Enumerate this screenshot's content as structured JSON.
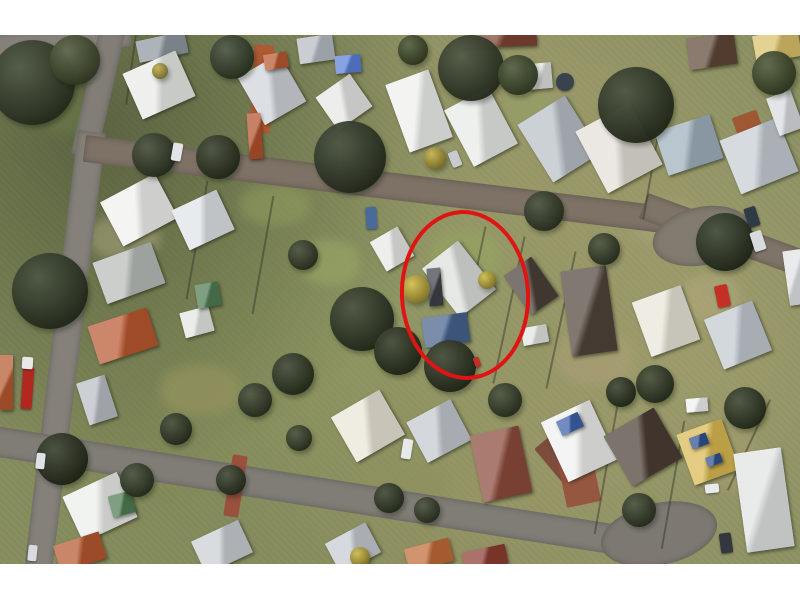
{
  "annotation": {
    "shape": "ellipse",
    "color": "#e11414",
    "stroke_width": 4,
    "x": 400,
    "y": 175,
    "w": 122,
    "h": 162,
    "rot": -3
  },
  "palette": {
    "page_margin": "#ffffff",
    "grass_base": "#8b9163",
    "road_gray": "#85817a",
    "road_brown_gray": "#7e7266",
    "highlight_red": "#e11414"
  },
  "photo_rect": {
    "x": 0,
    "y": 35,
    "w": 800,
    "h": 529
  },
  "scene": {
    "patches": [
      {
        "x": 90,
        "y": 180,
        "w": 70,
        "h": 45,
        "c": "#a3a07a"
      },
      {
        "x": 300,
        "y": 205,
        "w": 60,
        "h": 45,
        "c": "#9aa868"
      },
      {
        "x": 430,
        "y": 195,
        "w": 70,
        "h": 55,
        "c": "#96a562"
      },
      {
        "x": 630,
        "y": 165,
        "w": 70,
        "h": 45,
        "c": "#a8a478"
      },
      {
        "x": 555,
        "y": 295,
        "w": 80,
        "h": 55,
        "c": "#ab9f76"
      },
      {
        "x": 690,
        "y": 395,
        "w": 70,
        "h": 60,
        "c": "#a39c6e"
      },
      {
        "x": 160,
        "y": 330,
        "w": 80,
        "h": 50,
        "c": "#98955f"
      },
      {
        "x": 360,
        "y": 430,
        "w": 90,
        "h": 40,
        "c": "#8f9160"
      },
      {
        "x": 40,
        "y": 60,
        "w": 60,
        "h": 40,
        "c": "#6a7a4a"
      },
      {
        "x": 240,
        "y": 150,
        "w": 70,
        "h": 40,
        "c": "#8e9a5e"
      },
      {
        "x": 680,
        "y": 240,
        "w": 60,
        "h": 45,
        "c": "#b0a87c"
      },
      {
        "x": 500,
        "y": 55,
        "w": 60,
        "h": 40,
        "c": "#95a066"
      }
    ],
    "roads": [
      {
        "x": -10,
        "y": 0,
        "w": 140,
        "h": 26,
        "rot": -6,
        "og": "0 0",
        "c": "#85817a"
      },
      {
        "x": 100,
        "y": -8,
        "w": 26,
        "h": 130,
        "rot": 13,
        "og": "0 0",
        "c": "#827e77"
      },
      {
        "x": 78,
        "y": 95,
        "w": 28,
        "h": 450,
        "rot": 7,
        "og": "0 0",
        "c": "#85817a"
      },
      {
        "x": 86,
        "y": 100,
        "w": 590,
        "h": 27,
        "rot": 7,
        "og": "0 0",
        "c": "#7e7266"
      },
      {
        "x": 648,
        "y": 158,
        "w": 172,
        "h": 27,
        "rot": 20,
        "og": "0 0",
        "c": "#7e7467"
      },
      {
        "x": 652,
        "y": 172,
        "w": 100,
        "h": 58,
        "rot": -12,
        "rd": "50%",
        "c": "#817a6e"
      },
      {
        "x": -12,
        "y": 390,
        "w": 650,
        "h": 30,
        "rot": 9,
        "og": "0 0",
        "c": "#807c76"
      },
      {
        "x": 600,
        "y": 468,
        "w": 118,
        "h": 62,
        "rot": -12,
        "rd": "50%",
        "c": "#7d7972"
      }
    ],
    "driveways": [
      {
        "x": 252,
        "y": 10,
        "w": 20,
        "h": 88,
        "rot": 3,
        "c": "#b4552f"
      },
      {
        "x": 228,
        "y": 420,
        "w": 15,
        "h": 62,
        "rot": 9,
        "c": "#9b4a3a"
      },
      {
        "x": 543,
        "y": 392,
        "w": 52,
        "h": 46,
        "rot": -40,
        "c": "#7a4438"
      },
      {
        "x": 736,
        "y": 78,
        "w": 26,
        "h": 30,
        "rot": -20,
        "c": "#a0522d"
      },
      {
        "x": 560,
        "y": 405,
        "w": 35,
        "h": 65,
        "rot": -12,
        "c": "#96503c"
      }
    ],
    "fences": [
      {
        "x": 196,
        "y": 145,
        "w": 2,
        "h": 120,
        "rot": 10,
        "c": "#2f3327"
      },
      {
        "x": 262,
        "y": 160,
        "w": 2,
        "h": 120,
        "rot": 10,
        "c": "#2f3327"
      },
      {
        "x": 470,
        "y": 190,
        "w": 2,
        "h": 140,
        "rot": 12,
        "c": "#2f3327"
      },
      {
        "x": 508,
        "y": 200,
        "w": 2,
        "h": 150,
        "rot": 12,
        "c": "#2f3327"
      },
      {
        "x": 560,
        "y": 215,
        "w": 2,
        "h": 140,
        "rot": 12,
        "c": "#2f3327"
      },
      {
        "x": 650,
        "y": 95,
        "w": 2,
        "h": 90,
        "rot": 10,
        "c": "#2f3327"
      },
      {
        "x": 605,
        "y": 370,
        "w": 2,
        "h": 130,
        "rot": 10,
        "c": "#2f3327"
      },
      {
        "x": 672,
        "y": 385,
        "w": 2,
        "h": 130,
        "rot": 10,
        "c": "#2f3327"
      },
      {
        "x": 130,
        "y": 0,
        "w": 2,
        "h": 70,
        "rot": 8,
        "c": "#2f3327"
      },
      {
        "x": 748,
        "y": 360,
        "w": 2,
        "h": 100,
        "rot": 25,
        "c": "#2f3327"
      }
    ],
    "houses": [
      {
        "x": 137,
        "y": 1,
        "w": 50,
        "h": 22,
        "rot": -12,
        "c": "#8f969e"
      },
      {
        "x": 130,
        "y": 25,
        "w": 58,
        "h": 50,
        "rot": -24,
        "c": "#e9ebe7"
      },
      {
        "x": 298,
        "y": 1,
        "w": 36,
        "h": 26,
        "rot": -8,
        "c": "#b6bbc2"
      },
      {
        "x": 248,
        "y": 27,
        "w": 48,
        "h": 55,
        "rot": -30,
        "c": "#cfd3d8"
      },
      {
        "x": 264,
        "y": 18,
        "w": 24,
        "h": 16,
        "rot": -10,
        "c": "#b5572f"
      },
      {
        "x": 248,
        "y": 78,
        "w": 14,
        "h": 46,
        "rot": -4,
        "c": "#b0502c"
      },
      {
        "x": 335,
        "y": 20,
        "w": 26,
        "h": 18,
        "rot": -5,
        "c": "#5a7fd6"
      },
      {
        "x": 323,
        "y": 47,
        "w": 42,
        "h": 40,
        "rot": -35,
        "c": "#e6e7e4"
      },
      {
        "x": 396,
        "y": 40,
        "w": 46,
        "h": 72,
        "rot": -20,
        "c": "#eef0ec"
      },
      {
        "x": 456,
        "y": 60,
        "w": 50,
        "h": 64,
        "rot": -28,
        "c": "#e8eae6"
      },
      {
        "x": 462,
        "y": 0,
        "w": 75,
        "h": 12,
        "rot": -2,
        "c": "#7e4434"
      },
      {
        "x": 528,
        "y": 28,
        "w": 24,
        "h": 26,
        "rot": -5,
        "c": "#dfe1de"
      },
      {
        "x": 531,
        "y": 70,
        "w": 56,
        "h": 68,
        "rot": -32,
        "c": "#b9bfc6"
      },
      {
        "x": 588,
        "y": 78,
        "w": 62,
        "h": 70,
        "rot": -28,
        "c": "#e3e0d8"
      },
      {
        "x": 660,
        "y": 87,
        "w": 58,
        "h": 46,
        "rot": -18,
        "c": "#9fb0bd"
      },
      {
        "x": 728,
        "y": 92,
        "w": 62,
        "h": 58,
        "rot": -22,
        "c": "#c6cdd4"
      },
      {
        "x": 688,
        "y": 0,
        "w": 48,
        "h": 32,
        "rot": -8,
        "c": "#5e4637"
      },
      {
        "x": 754,
        "y": -3,
        "w": 46,
        "h": 28,
        "rot": -10,
        "c": "#d9c06a"
      },
      {
        "x": 772,
        "y": 58,
        "w": 26,
        "h": 40,
        "rot": -20,
        "c": "#d8dbde"
      },
      {
        "x": 108,
        "y": 150,
        "w": 62,
        "h": 50,
        "rot": -28,
        "c": "#f0f1ee"
      },
      {
        "x": 178,
        "y": 163,
        "w": 50,
        "h": 44,
        "rot": -25,
        "c": "#dfe3e6"
      },
      {
        "x": 98,
        "y": 216,
        "w": 62,
        "h": 44,
        "rot": -20,
        "c": "#b7bcb9"
      },
      {
        "x": 92,
        "y": 281,
        "w": 62,
        "h": 40,
        "rot": -18,
        "c": "#b9572f"
      },
      {
        "x": 182,
        "y": 274,
        "w": 30,
        "h": 26,
        "rot": -15,
        "c": "#e4e6e3"
      },
      {
        "x": 196,
        "y": 248,
        "w": 24,
        "h": 24,
        "rot": -10,
        "c": "#4e7a52"
      },
      {
        "x": 376,
        "y": 197,
        "w": 32,
        "h": 34,
        "rot": -30,
        "c": "#e7e9e6"
      },
      {
        "x": 436,
        "y": 213,
        "w": 46,
        "h": 62,
        "rot": -38,
        "c": "#dcdfdc"
      },
      {
        "x": 428,
        "y": 233,
        "w": 14,
        "h": 38,
        "rot": -5,
        "c": "#3c4148"
      },
      {
        "x": 423,
        "y": 280,
        "w": 46,
        "h": 30,
        "rot": -8,
        "c": "#46628c"
      },
      {
        "x": 514,
        "y": 227,
        "w": 34,
        "h": 48,
        "rot": -35,
        "c": "#4a4038"
      },
      {
        "x": 522,
        "y": 291,
        "w": 26,
        "h": 18,
        "rot": -10,
        "c": "#e2e4e1"
      },
      {
        "x": 566,
        "y": 233,
        "w": 46,
        "h": 86,
        "rot": -8,
        "c": "#4f443a"
      },
      {
        "x": 640,
        "y": 257,
        "w": 52,
        "h": 58,
        "rot": -20,
        "c": "#e8e4d8"
      },
      {
        "x": 712,
        "y": 273,
        "w": 52,
        "h": 54,
        "rot": -22,
        "c": "#c2c9d0"
      },
      {
        "x": 786,
        "y": 215,
        "w": 18,
        "h": 55,
        "rot": -8,
        "c": "#dfe2e5"
      },
      {
        "x": 340,
        "y": 365,
        "w": 56,
        "h": 52,
        "rot": -30,
        "c": "#e9e4d6"
      },
      {
        "x": 414,
        "y": 373,
        "w": 50,
        "h": 46,
        "rot": -28,
        "c": "#c3c8cf"
      },
      {
        "x": 476,
        "y": 395,
        "w": 50,
        "h": 68,
        "rot": -12,
        "c": "#8a4a3a"
      },
      {
        "x": 552,
        "y": 373,
        "w": 54,
        "h": 66,
        "rot": -25,
        "c": "#eff0ee"
      },
      {
        "x": 558,
        "y": 381,
        "w": 24,
        "h": 16,
        "rot": -25,
        "c": "#3b5fa8"
      },
      {
        "x": 614,
        "y": 383,
        "w": 58,
        "h": 58,
        "rot": -30,
        "c": "#4a3d33"
      },
      {
        "x": 684,
        "y": 390,
        "w": 48,
        "h": 54,
        "rot": -20,
        "c": "#d9b952"
      },
      {
        "x": 690,
        "y": 400,
        "w": 18,
        "h": 12,
        "rot": -20,
        "c": "#2f4f8f"
      },
      {
        "x": 706,
        "y": 420,
        "w": 16,
        "h": 10,
        "rot": -20,
        "c": "#2f4f8f"
      },
      {
        "x": 740,
        "y": 415,
        "w": 48,
        "h": 100,
        "rot": -8,
        "c": "#dfe3e2"
      },
      {
        "x": 686,
        "y": 363,
        "w": 22,
        "h": 14,
        "rot": -5,
        "c": "#eef0ef"
      },
      {
        "x": 70,
        "y": 447,
        "w": 60,
        "h": 50,
        "rot": -25,
        "c": "#eceeeb"
      },
      {
        "x": 110,
        "y": 458,
        "w": 24,
        "h": 22,
        "rot": -15,
        "c": "#4e7a52"
      },
      {
        "x": 56,
        "y": 503,
        "w": 48,
        "h": 28,
        "rot": -18,
        "c": "#b5572f"
      },
      {
        "x": 196,
        "y": 494,
        "w": 52,
        "h": 36,
        "rot": -25,
        "c": "#c9ced3"
      },
      {
        "x": 330,
        "y": 496,
        "w": 46,
        "h": 34,
        "rot": -28,
        "c": "#c6cbd1"
      },
      {
        "x": 406,
        "y": 508,
        "w": 46,
        "h": 24,
        "rot": -15,
        "c": "#c06a38"
      },
      {
        "x": 463,
        "y": 513,
        "w": 44,
        "h": 20,
        "rot": -12,
        "c": "#8a3c30"
      },
      {
        "x": 0,
        "y": 320,
        "w": 13,
        "h": 55,
        "rot": 0,
        "c": "#b5572f"
      },
      {
        "x": 82,
        "y": 343,
        "w": 30,
        "h": 44,
        "rot": -18,
        "c": "#b9bec4"
      }
    ],
    "trees": [
      {
        "x": -10,
        "y": 5,
        "d": 85,
        "c": "#39442c"
      },
      {
        "x": 50,
        "y": 0,
        "d": 50,
        "c": "#4a5634"
      },
      {
        "x": 12,
        "y": 218,
        "d": 76,
        "c": "#343f28"
      },
      {
        "x": 132,
        "y": 98,
        "d": 44,
        "c": "#39442c"
      },
      {
        "x": 196,
        "y": 100,
        "d": 44,
        "c": "#323c26"
      },
      {
        "x": 210,
        "y": 0,
        "d": 44,
        "c": "#3c4830"
      },
      {
        "x": 314,
        "y": 86,
        "d": 72,
        "c": "#343e29"
      },
      {
        "x": 438,
        "y": 0,
        "d": 66,
        "c": "#39432c"
      },
      {
        "x": 598,
        "y": 32,
        "d": 76,
        "c": "#333d27"
      },
      {
        "x": 398,
        "y": 0,
        "d": 30,
        "c": "#45522f"
      },
      {
        "x": 498,
        "y": 20,
        "d": 40,
        "c": "#42502e"
      },
      {
        "x": 752,
        "y": 16,
        "d": 44,
        "c": "#45522f"
      },
      {
        "x": 524,
        "y": 156,
        "d": 40,
        "c": "#39432c"
      },
      {
        "x": 588,
        "y": 198,
        "d": 32,
        "c": "#3a442c"
      },
      {
        "x": 696,
        "y": 178,
        "d": 58,
        "c": "#2f3a25"
      },
      {
        "x": 330,
        "y": 252,
        "d": 64,
        "c": "#333d27"
      },
      {
        "x": 374,
        "y": 292,
        "d": 48,
        "c": "#2e3722"
      },
      {
        "x": 424,
        "y": 305,
        "d": 52,
        "c": "#2f3823"
      },
      {
        "x": 288,
        "y": 205,
        "d": 30,
        "c": "#39432c"
      },
      {
        "x": 636,
        "y": 330,
        "d": 38,
        "c": "#353f28"
      },
      {
        "x": 606,
        "y": 342,
        "d": 30,
        "c": "#2f3823"
      },
      {
        "x": 488,
        "y": 348,
        "d": 34,
        "c": "#39432c"
      },
      {
        "x": 272,
        "y": 318,
        "d": 42,
        "c": "#333d27"
      },
      {
        "x": 238,
        "y": 348,
        "d": 34,
        "c": "#39432c"
      },
      {
        "x": 160,
        "y": 378,
        "d": 32,
        "c": "#343e28"
      },
      {
        "x": 36,
        "y": 398,
        "d": 52,
        "c": "#2c3520"
      },
      {
        "x": 120,
        "y": 428,
        "d": 34,
        "c": "#39432c"
      },
      {
        "x": 216,
        "y": 430,
        "d": 30,
        "c": "#343e28"
      },
      {
        "x": 286,
        "y": 390,
        "d": 26,
        "c": "#3a442c"
      },
      {
        "x": 724,
        "y": 352,
        "d": 42,
        "c": "#333d27"
      },
      {
        "x": 622,
        "y": 458,
        "d": 34,
        "c": "#39432c"
      },
      {
        "x": 374,
        "y": 448,
        "d": 30,
        "c": "#343e28"
      },
      {
        "x": 414,
        "y": 462,
        "d": 26,
        "c": "#39432c"
      },
      {
        "x": 402,
        "y": 240,
        "d": 28,
        "c": "#d2bb3e"
      },
      {
        "x": 478,
        "y": 236,
        "d": 18,
        "c": "#cdb73c"
      },
      {
        "x": 424,
        "y": 112,
        "d": 22,
        "c": "#c0ad3f"
      },
      {
        "x": 350,
        "y": 512,
        "d": 20,
        "c": "#c9b63e"
      },
      {
        "x": 152,
        "y": 28,
        "d": 16,
        "c": "#b8a83e"
      }
    ],
    "vehicles": [
      {
        "x": 22,
        "y": 332,
        "w": 11,
        "h": 42,
        "rot": 4,
        "c": "#b02820"
      },
      {
        "x": 22,
        "y": 322,
        "w": 11,
        "h": 12,
        "rot": 4,
        "c": "#e8e8e8"
      },
      {
        "x": 716,
        "y": 250,
        "w": 13,
        "h": 22,
        "rot": -12,
        "c": "#c23026"
      },
      {
        "x": 366,
        "y": 172,
        "w": 11,
        "h": 22,
        "rot": -4,
        "c": "#4a6a9a"
      },
      {
        "x": 172,
        "y": 108,
        "w": 10,
        "h": 18,
        "rot": 10,
        "c": "#e2e4e6"
      },
      {
        "x": 450,
        "y": 116,
        "w": 10,
        "h": 16,
        "rot": -22,
        "c": "#c8ccd0"
      },
      {
        "x": 746,
        "y": 172,
        "w": 12,
        "h": 20,
        "rot": -18,
        "c": "#2e3a46"
      },
      {
        "x": 752,
        "y": 196,
        "w": 12,
        "h": 20,
        "rot": -18,
        "c": "#d8dbde"
      },
      {
        "x": 402,
        "y": 404,
        "w": 10,
        "h": 20,
        "rot": 9,
        "c": "#e6e8ea"
      },
      {
        "x": 705,
        "y": 449,
        "w": 14,
        "h": 9,
        "rot": -6,
        "c": "#e8eaec"
      },
      {
        "x": 720,
        "y": 498,
        "w": 12,
        "h": 20,
        "rot": -8,
        "c": "#33383f"
      },
      {
        "x": 36,
        "y": 418,
        "w": 9,
        "h": 16,
        "rot": 6,
        "c": "#dfe2e4"
      },
      {
        "x": 28,
        "y": 510,
        "w": 9,
        "h": 16,
        "rot": 6,
        "c": "#d8dadd"
      },
      {
        "x": 556,
        "y": 38,
        "w": 18,
        "h": 18,
        "rot": 0,
        "rd": "50%",
        "c": "#39434d"
      },
      {
        "x": 474,
        "y": 322,
        "w": 6,
        "h": 10,
        "rot": -20,
        "c": "#c03028"
      }
    ]
  }
}
